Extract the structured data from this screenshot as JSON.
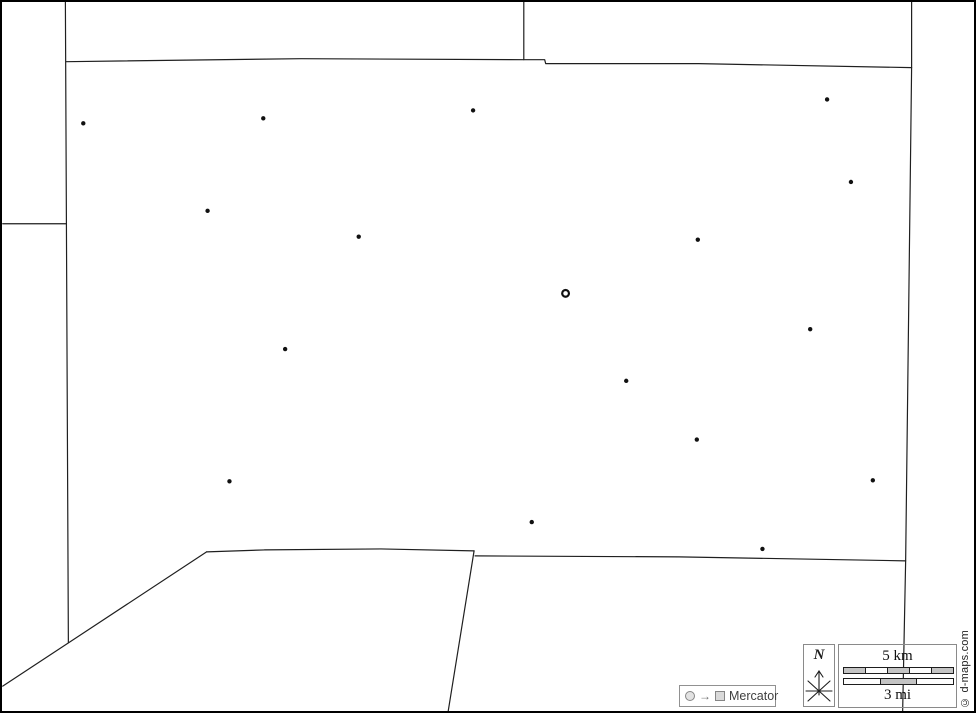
{
  "map": {
    "legend": {
      "projection_label": "Mercator",
      "arrow_glyph": "→"
    },
    "compass": {
      "north_label": "N"
    },
    "scale": {
      "km_label": "5 km",
      "mi_label": "3 mi",
      "km_segments": 5,
      "mi_segments": 3
    },
    "copyright": "© d-maps.com",
    "colors": {
      "boundary_line": "#1f1f1f",
      "town_dot": "#111111",
      "capital_ring": "#111111",
      "scale_fill_gray": "#c4c4c4",
      "legend_border": "#919191",
      "legend_text": "#3f3f3f",
      "frame": "#000000",
      "background": "#ffffff"
    },
    "towns": [
      [
        81,
        122
      ],
      [
        262,
        117
      ],
      [
        473,
        109
      ],
      [
        829,
        98
      ],
      [
        853,
        181
      ],
      [
        206,
        210
      ],
      [
        358,
        236
      ],
      [
        699,
        239
      ],
      [
        812,
        329
      ],
      [
        284,
        349
      ],
      [
        627,
        381
      ],
      [
        698,
        440
      ],
      [
        228,
        482
      ],
      [
        875,
        481
      ],
      [
        532,
        523
      ],
      [
        764,
        550
      ]
    ],
    "capital_town": [
      566,
      293
    ]
  }
}
